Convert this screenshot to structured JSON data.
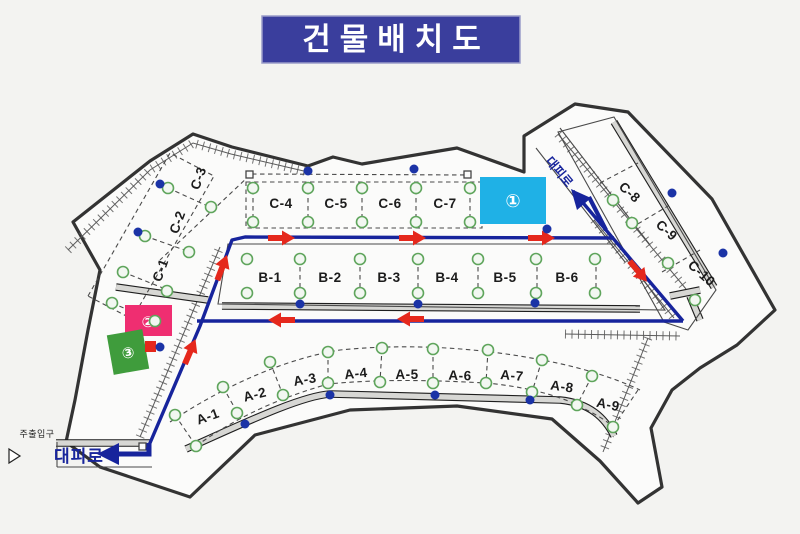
{
  "title": "건물배치도",
  "roads": {
    "evac_top": "대피로",
    "evac_bottom": "대피로",
    "main_entrance": "주출입구"
  },
  "markers": {
    "area1": {
      "label": "①",
      "color": "#1fb1e6"
    },
    "area2": {
      "label": "②",
      "color": "#ef2e71"
    },
    "area3": {
      "label": "③",
      "color": "#3f9c3c"
    }
  },
  "buildings": {
    "a": [
      "A-1",
      "A-2",
      "A-3",
      "A-4",
      "A-5",
      "A-6",
      "A-7",
      "A-8",
      "A-9"
    ],
    "b": [
      "B-1",
      "B-2",
      "B-3",
      "B-4",
      "B-5",
      "B-6"
    ],
    "c": [
      "C-1",
      "C-2",
      "C-3",
      "C-4",
      "C-5",
      "C-6",
      "C-7",
      "C-8",
      "C-9",
      "C-10"
    ]
  },
  "colors": {
    "route_blue": "#17249c",
    "arrow_red": "#e5281c",
    "banner_blue": "#3a3e9d",
    "boundary_gray": "#333333",
    "tree_circle_green": "#5fa55c",
    "dot_blue": "#1b33a6"
  }
}
